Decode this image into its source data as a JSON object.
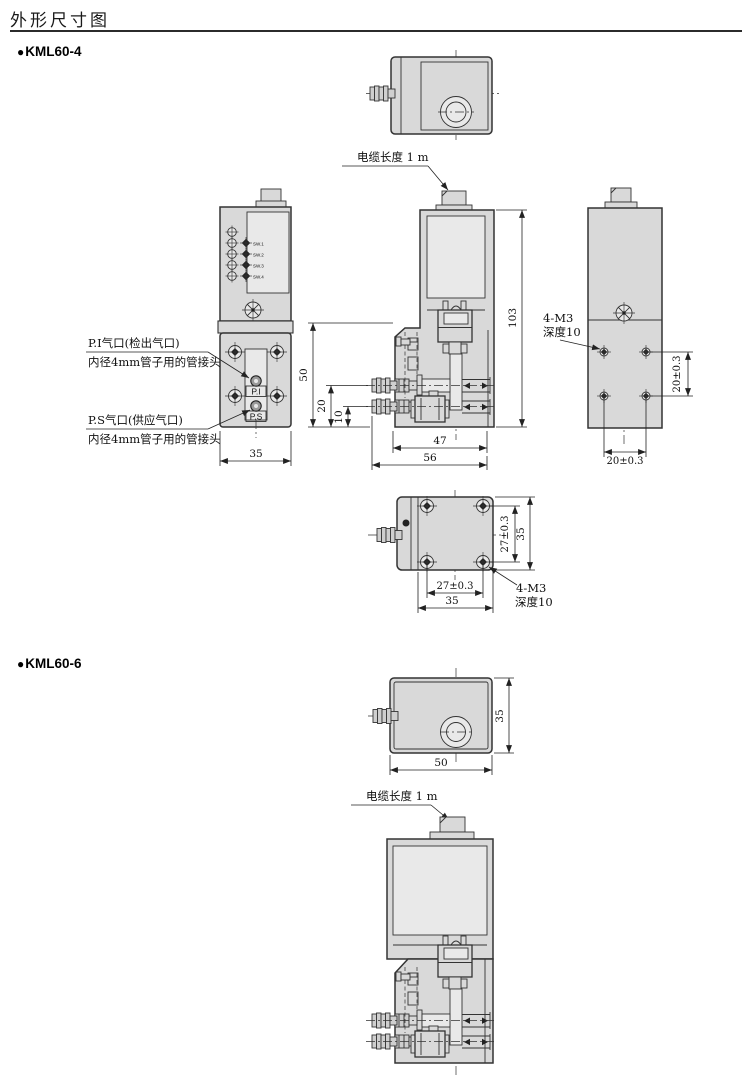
{
  "page": {
    "title": "外形尺寸图",
    "bg": "#ffffff",
    "line_color": "#2f2f2f",
    "body_fill": "#d9d9d9"
  },
  "kml60_4": {
    "bullet": "●",
    "model": "KML60-4",
    "cable_label": "电缆长度 1 m",
    "sw_labels": [
      "SW.1",
      "SW.2",
      "SW.3",
      "SW.4"
    ],
    "ports": {
      "pi": "P.I",
      "ps": "P.S"
    },
    "annotations": {
      "pi_title": "P.I气口(检出气口)",
      "pi_sub": "内径4mm管子用的管接头",
      "ps_title": "P.S气口(供应气口)",
      "ps_sub": "内径4mm管子用的管接头",
      "m3_rear_line1": "4-M3",
      "m3_rear_line2": "深度10",
      "m3_bottom_line1": "4-M3",
      "m3_bottom_line2": "深度10"
    },
    "dims": {
      "front_width": "35",
      "overall_height": "103",
      "lower_height": "50",
      "upper_port_height": "20",
      "lower_port_height": "10",
      "depth_inner": "47",
      "depth_overall": "56",
      "rear_hole_pitch_v": "20±0.3",
      "rear_hole_pitch_h": "20±0.3",
      "bottom_hole_pitch_v": "27±0.3",
      "bottom_depth": "35",
      "bottom_hole_pitch_h": "27±0.3",
      "bottom_width": "35"
    }
  },
  "kml60_6": {
    "bullet": "●",
    "model": "KML60-6",
    "cable_label": "电缆长度 1 m",
    "dims": {
      "top_height": "35",
      "top_width": "50"
    }
  }
}
